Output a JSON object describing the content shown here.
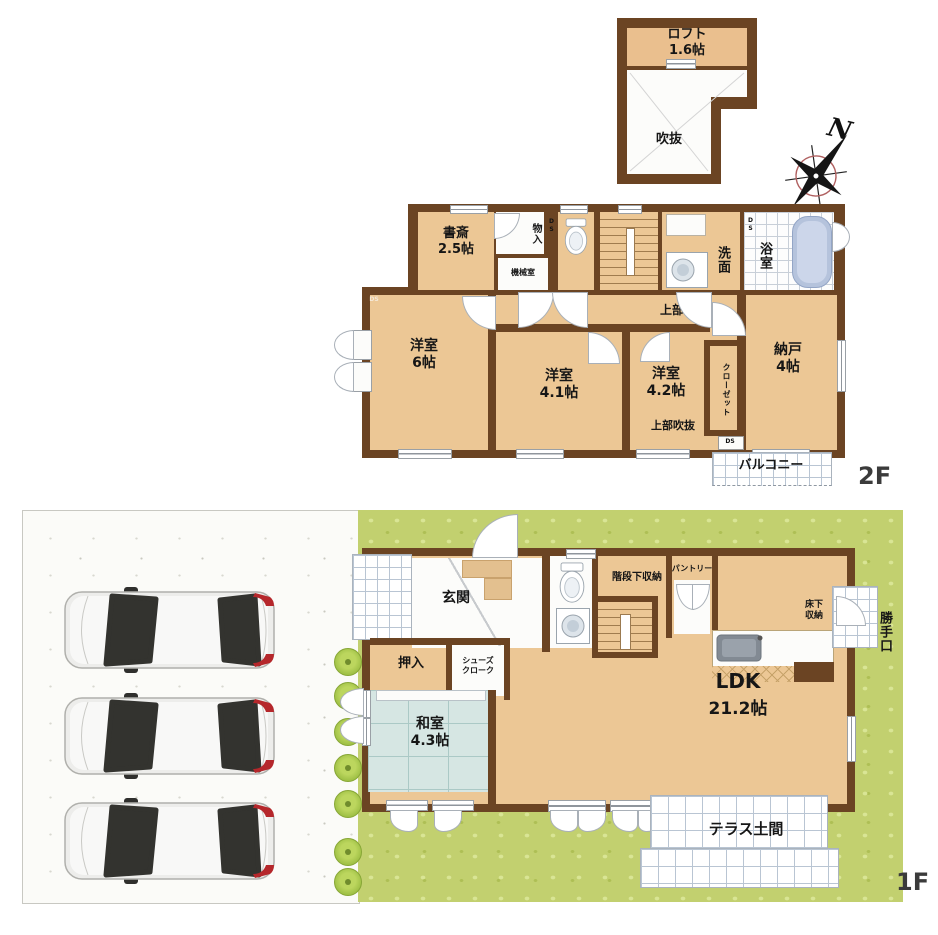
{
  "meta": {
    "floor2_tag": "2F",
    "floor1_tag": "1F",
    "compass_north": "N",
    "ds": "DS"
  },
  "loft": {
    "name": "ロフト",
    "size": "1.6帖",
    "void": "吹抜"
  },
  "f2": {
    "study_name": "書斎",
    "study_size": "2.5帖",
    "storage": "物入",
    "machine": "機械室",
    "wash": "洗面",
    "bath": "浴室",
    "upper_loft": "上部ロフト",
    "west6_name": "洋室",
    "west6_size": "6帖",
    "west41_name": "洋室",
    "west41_size": "4.1帖",
    "west42_name": "洋室",
    "west42_size": "4.2帖",
    "upper_void": "上部吹抜",
    "closet": "クローゼット",
    "nando_name": "納戸",
    "nando_size": "4帖",
    "balcony": "バルコニー"
  },
  "f1": {
    "entrance": "玄関",
    "oshiire": "押入",
    "shoes1": "シューズ",
    "shoes2": "クローク",
    "understair": "階段下収納",
    "pantry": "パントリー",
    "underfloor1": "床下",
    "underfloor2": "収納",
    "backdoor": "勝手口",
    "washitsu_name": "和室",
    "washitsu_size": "4.3帖",
    "ldk_name": "LDK",
    "ldk_size": "21.2帖",
    "terrace": "テラス土間"
  },
  "colors": {
    "wall": "#6b4423",
    "floor": "#ecc795",
    "tatami": "#d6e6e3",
    "grass": "#c2d06f",
    "tub": "#b5c3dc",
    "tail_light": "#b5272b"
  }
}
